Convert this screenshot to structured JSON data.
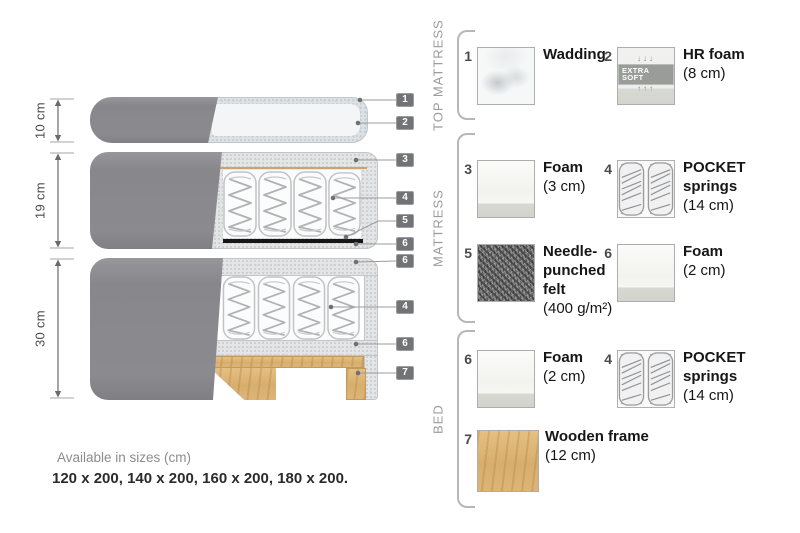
{
  "colors": {
    "fabric_gray": "#8b8b8f",
    "foam_speckle": "#e4e5e6",
    "wadding": "#dde2e6",
    "wood": "#dcb274",
    "felt_dark": "#1c1c1c",
    "tag_bg": "#717376",
    "text_dark": "#161616",
    "text_gray": "#9c9c9c"
  },
  "diagram": {
    "dims": [
      "10 cm",
      "19 cm",
      "30 cm"
    ],
    "tags": [
      "1",
      "2",
      "3",
      "4",
      "5",
      "6",
      "6",
      "4",
      "6",
      "7"
    ]
  },
  "legend": {
    "groups": [
      {
        "label": "TOP MATTRESS",
        "items": [
          {
            "num": "1",
            "name": "Wadding",
            "detail": ""
          },
          {
            "num": "2",
            "name": "HR foam",
            "detail": "(8 cm)",
            "badge": "EXTRA SOFT",
            "badge_arrows_down": "↓↓↓",
            "badge_arrows_up": "↑↑↑"
          }
        ]
      },
      {
        "label": "MATTRESS",
        "items": [
          {
            "num": "3",
            "name": "Foam",
            "detail": "(3 cm)"
          },
          {
            "num": "4",
            "name": "POCKET springs",
            "detail": "(14 cm)"
          },
          {
            "num": "5",
            "name": "Needle-punched felt",
            "detail": "(400 g/m²)"
          },
          {
            "num": "6",
            "name": "Foam",
            "detail": "(2 cm)"
          }
        ]
      },
      {
        "label": "BED",
        "items": [
          {
            "num": "6",
            "name": "Foam",
            "detail": "(2 cm)"
          },
          {
            "num": "4",
            "name": "POCKET springs",
            "detail": "(14 cm)"
          },
          {
            "num": "7",
            "name": "Wooden frame",
            "detail": "(12 cm)"
          }
        ]
      }
    ]
  },
  "footer": {
    "line1": "Available in sizes (cm)",
    "line2": "120 x 200, 140 x 200, 160 x 200, 180 x 200."
  }
}
